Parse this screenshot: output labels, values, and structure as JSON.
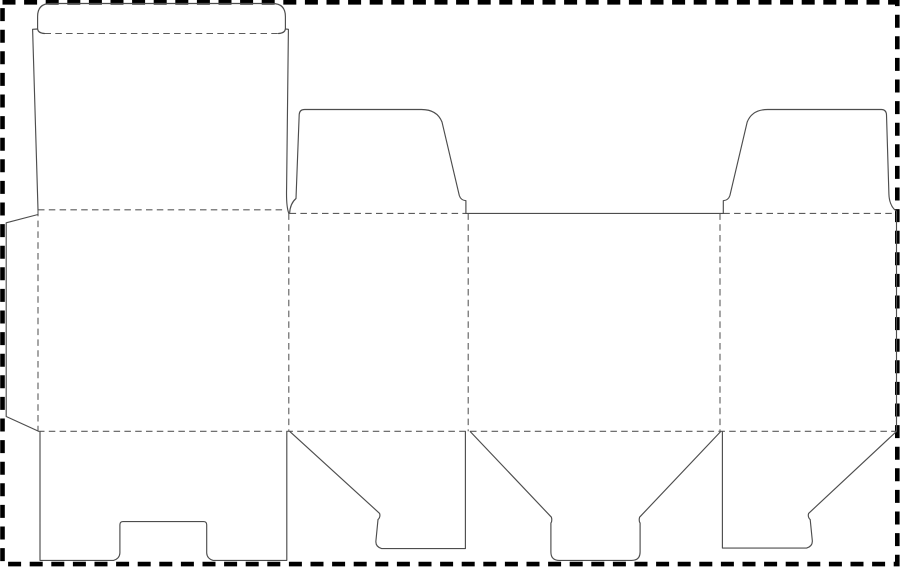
{
  "canvas": {
    "width": 900,
    "height": 567,
    "background": "#ffffff"
  },
  "styles": {
    "page_border_color": "#000000",
    "page_border_width": 4.6,
    "page_border_dash": "13 8.6",
    "cut_line_color": "#4d4d4d",
    "cut_line_width": 1.15,
    "fold_line_color": "#5c5c5c",
    "fold_line_width": 1.1,
    "fold_line_dash": "6.5 4.3"
  },
  "page_border": {
    "x": 2.5,
    "y": 2.3,
    "width": 894.8,
    "height": 561.8
  },
  "cut_paths": [
    {
      "name": "tuck-flap-cut",
      "d": "M 44.5 33.5 Q 38.2 33.2 37.6 29 L 37.6 16.5 Q 37.6 3.5 50.6 3.5 L 272.4 3.5 Q 285.4 3.5 285.4 16.5 L 285.4 29 Q 284.8 33.2 278.5 33.5"
    },
    {
      "name": "lid-panel-left-edge-cut",
      "d": "M 37.6 29 L 32.6 29.3 L 38 209.8"
    },
    {
      "name": "lid-panel-right-edge-cut",
      "d": "M 285.4 29 L 288.4 29.3 L 286.6 188 Q 286.1 206.5 288.8 213.3"
    },
    {
      "name": "glue-flap-cut",
      "d": "M 38 214.5 L 6.2 222.8 L 6.2 416.5 L 38 431"
    },
    {
      "name": "dust-flap-left-cut",
      "d": "M 289.6 213.4 Q 290.1 203.5 296 198.5 L 299.2 114.5 Q 299.6 109.5 304.6 109.5 L 421.5 109.5 Q 437 109.5 442 122 L 459.3 195.5 Q 460.8 200.3 465.9 200.7 L 465.9 213.4"
    },
    {
      "name": "back-panel-top-edge-cut",
      "d": "M 465.9 213.4 L 723.3 213.4"
    },
    {
      "name": "dust-flap-right-cut",
      "d": "M 723.3 213.4 L 723.3 200.7 Q 728.4 200.3 729.9 195.5 L 747.2 122 Q 752.2 109.5 767.7 109.5 L 881.3 109.5 Q 886.2 109.5 886.5 114.8 L 888.9 194 Q 889.3 206 896.5 211.3"
    },
    {
      "name": "right-panel-side-edge-cut",
      "d": "M 896.5 211.3 L 896.5 431.3"
    },
    {
      "name": "bottom-lid-panel-notched-cut",
      "d": "M 40 431.6 L 40 560.4 L 113.5 560.4 Q 119.6 558.6 119.9 553 L 119.9 524.8 Q 119.9 521.6 123.1 521.6 L 203.5 521.6 Q 206.7 521.6 206.7 524.8 L 206.7 553 Q 207 558.6 213.1 560.4 L 286.8 560.4 L 286.8 431.6"
    },
    {
      "name": "bottom-flap-left-angled-cut",
      "d": "M 289.9 431.6 L 379.6 513.4 Q 380.7 517 378 519.6 L 375.9 541 Q 375.4 546.6 381.6 548.6 L 465.4 548.6 L 465.4 431.6"
    },
    {
      "name": "bottom-flap-center-funnel-cut",
      "d": "M 470.3 431.6 L 551.4 517.2 Q 552.4 520.8 550.9 523.1 L 550.9 552 Q 550.9 560.4 559.4 560.4 L 631.6 560.4 Q 640.1 560.4 640.1 552 L 640.1 523.1 Q 638.6 520.8 639.6 517.2 L 720.6 431.6"
    },
    {
      "name": "bottom-flap-right-angled-cut",
      "d": "M 722.4 431.6 L 722.4 548.1 L 806.6 548.1 Q 812.8 546.1 812.3 540.5 L 810.2 519.6 Q 807.5 517 808.6 513.4 L 896.5 431.4"
    }
  ],
  "fold_paths": [
    {
      "name": "tuck-flap-fold",
      "d": "M 44.5 33.5 L 278.5 33.5"
    },
    {
      "name": "lid-hinge-fold",
      "d": "M 38 209.8 L 286.2 209.8"
    },
    {
      "name": "top-fold-side-panel-left",
      "d": "M 289.6 213.4 L 465.9 213.4"
    },
    {
      "name": "top-fold-side-panel-right",
      "d": "M 723.3 213.4 L 893.5 213.4"
    },
    {
      "name": "glue-flap-fold",
      "d": "M 38 209.8 L 38 431.3"
    },
    {
      "name": "panel-fold-1",
      "d": "M 288.8 213.4 L 288.8 431.3"
    },
    {
      "name": "panel-fold-2",
      "d": "M 468.2 213.4 L 468.2 431.3"
    },
    {
      "name": "panel-fold-3",
      "d": "M 720 213.4 L 720 431.3"
    },
    {
      "name": "bottom-fold",
      "d": "M 38 431.3 L 896.5 431.3"
    }
  ]
}
